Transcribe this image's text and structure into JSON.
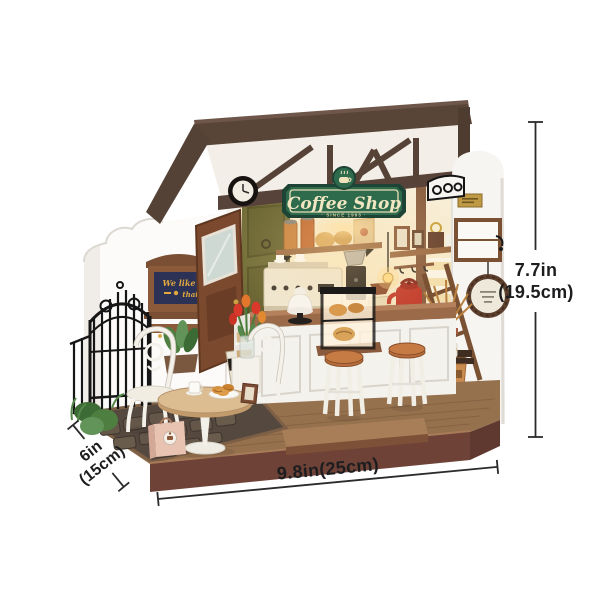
{
  "image": {
    "description": "Product photo of a miniature DIY coffee shop dollhouse kit, shown with measurement annotation lines for height, width and depth"
  },
  "sign": {
    "title": "Coffee Shop",
    "subtitle": "· SINCE 1993 ·"
  },
  "wall_board": {
    "line1": "We like",
    "line2": "that!"
  },
  "dimensions": {
    "height_in": "7.7in",
    "height_cm": "(19.5cm)",
    "width_label": "9.8in(25cm)",
    "depth_in": "6in",
    "depth_cm": "(15cm)"
  },
  "colors": {
    "sign_green": "#2e6b4d",
    "sign_green_dark": "#1d4434",
    "roof_brown": "#594537",
    "base_front_brown": "#6e4237",
    "deck_wood": "#96714e",
    "kettle_red": "#c23a2c",
    "dimension_ink": "#1d1d1f"
  }
}
